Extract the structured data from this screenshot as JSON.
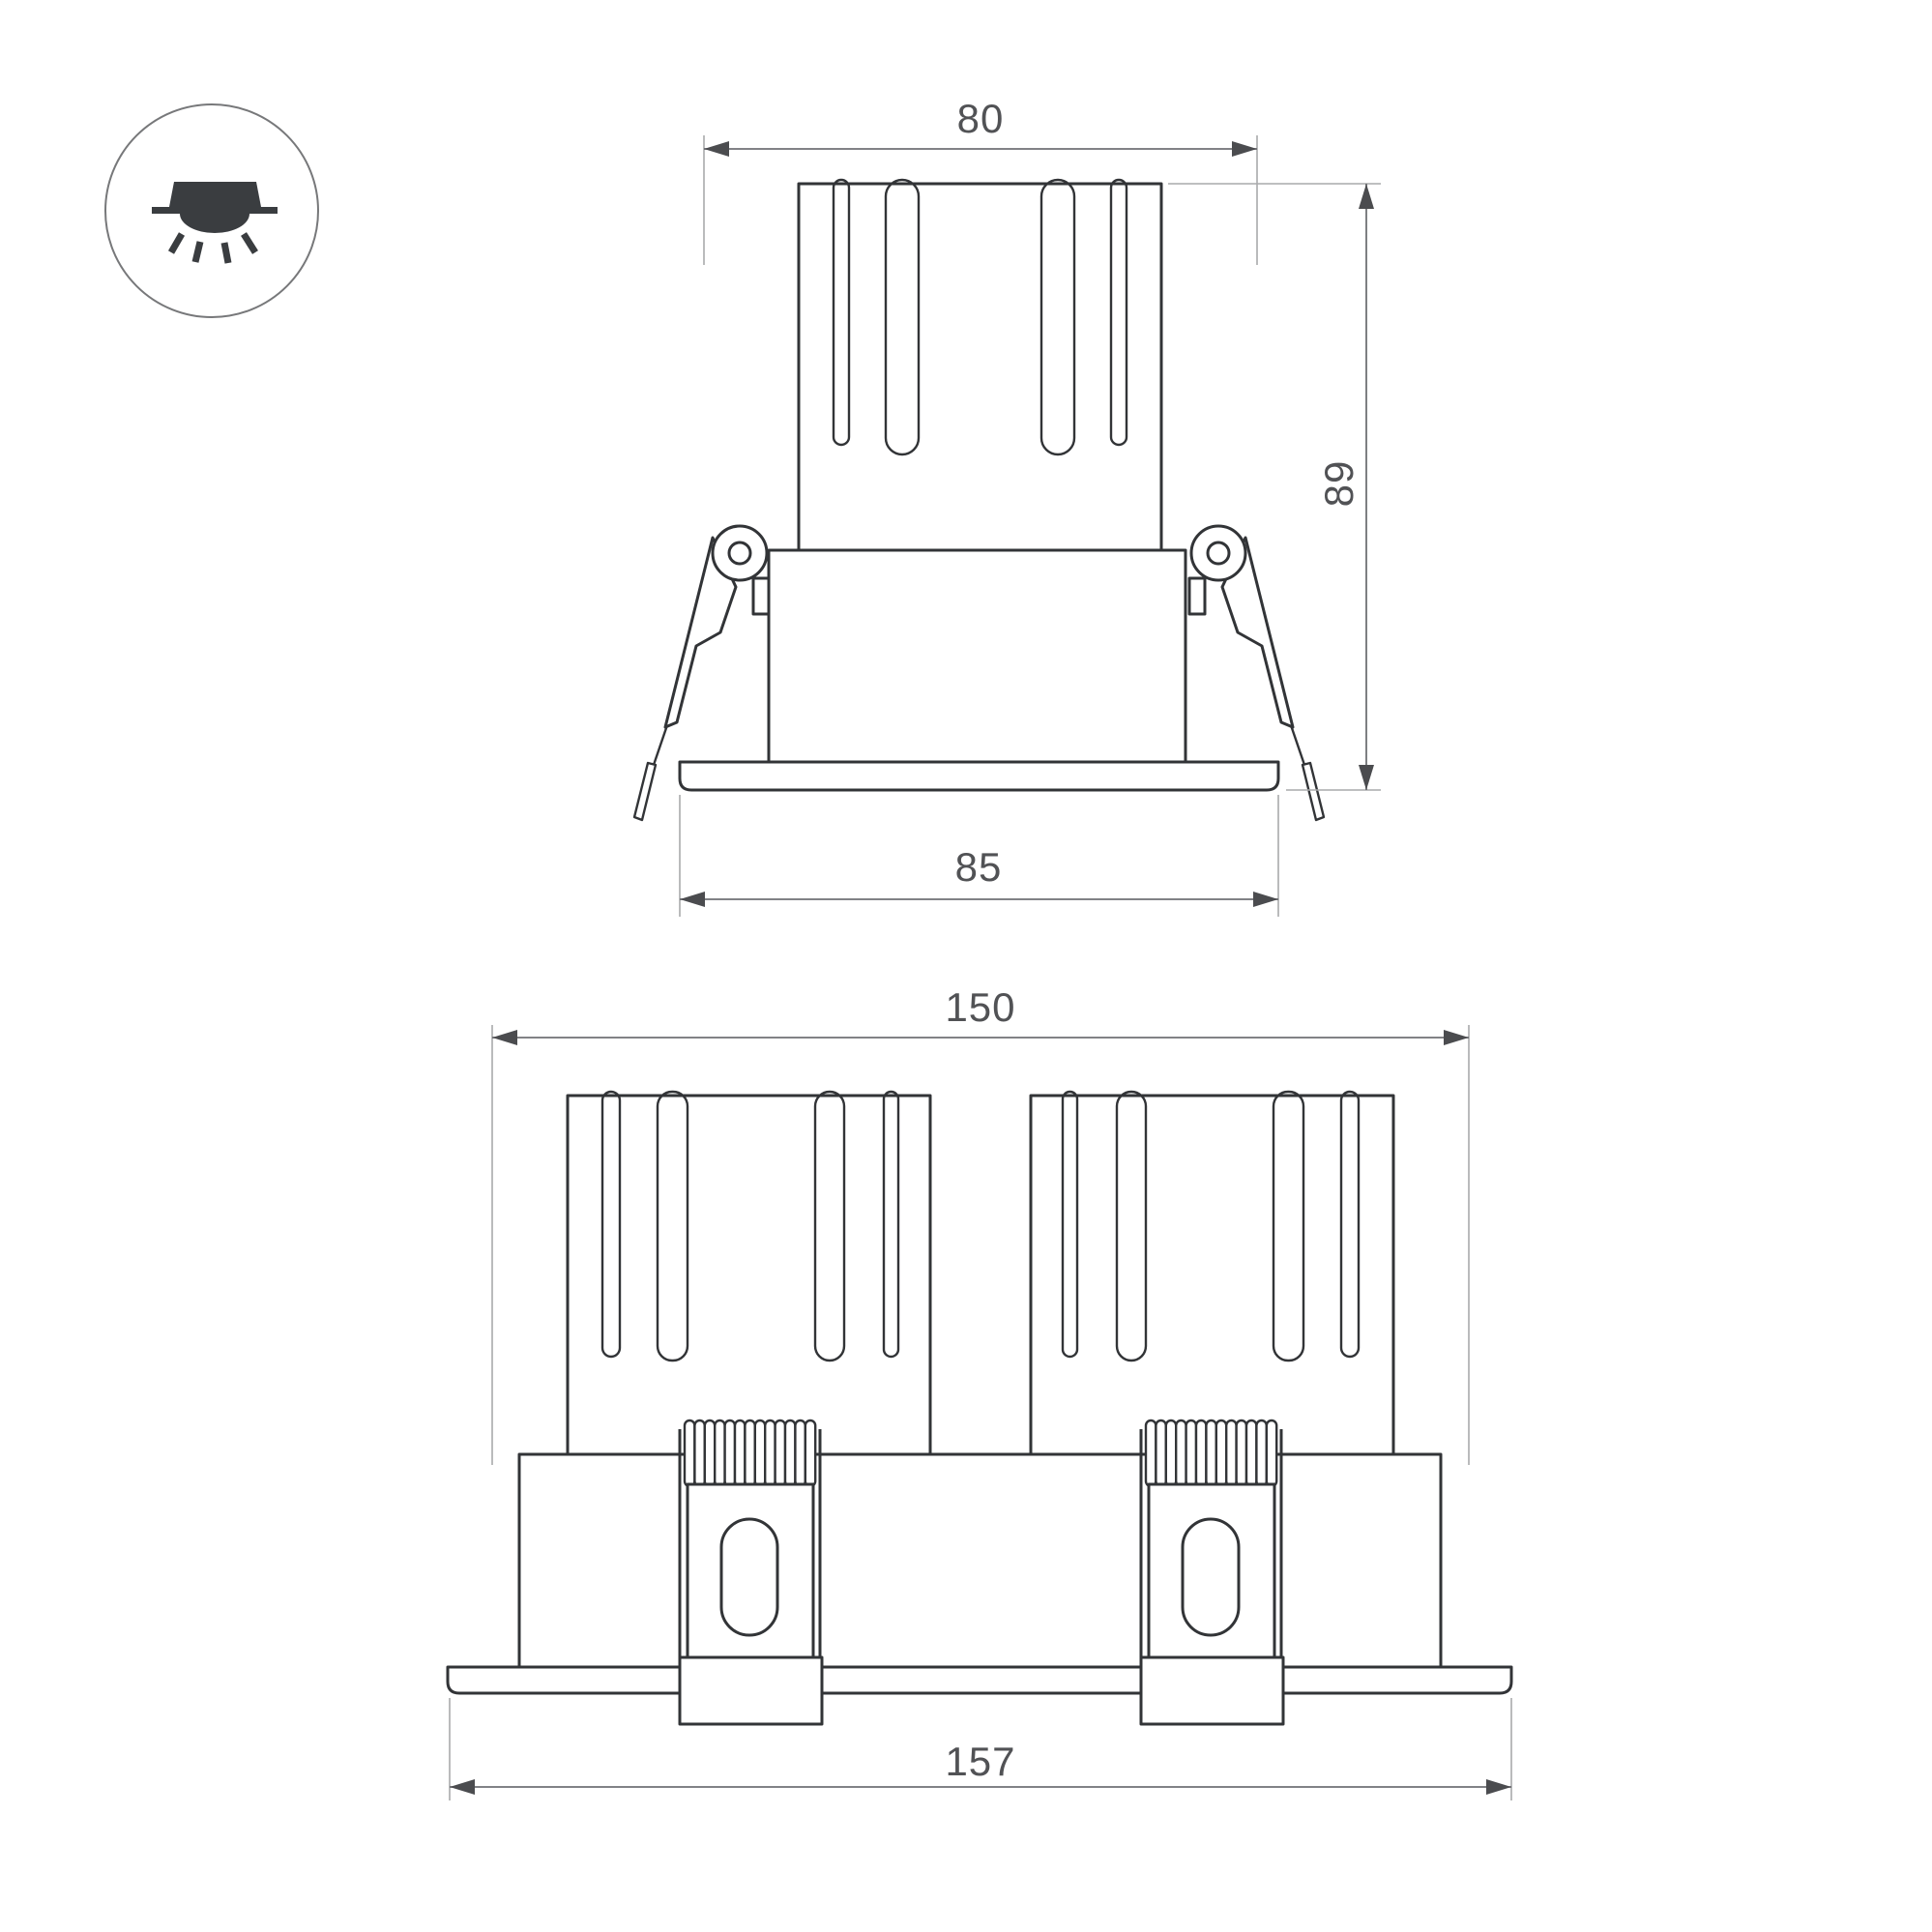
{
  "icon": {
    "name": "recessed-downlight-icon"
  },
  "dims": {
    "single_top_width": "80",
    "single_height": "89",
    "single_flange_width": "85",
    "double_cutout_width": "150",
    "double_flange_width": "157"
  },
  "colors": {
    "geometry": "#323437",
    "dimension": "#6f7174",
    "extension": "#a9aaac",
    "arrow": "#4b4c4f",
    "text": "#515255",
    "icon": "#3a3d40",
    "icon_circle": "#77787a"
  }
}
